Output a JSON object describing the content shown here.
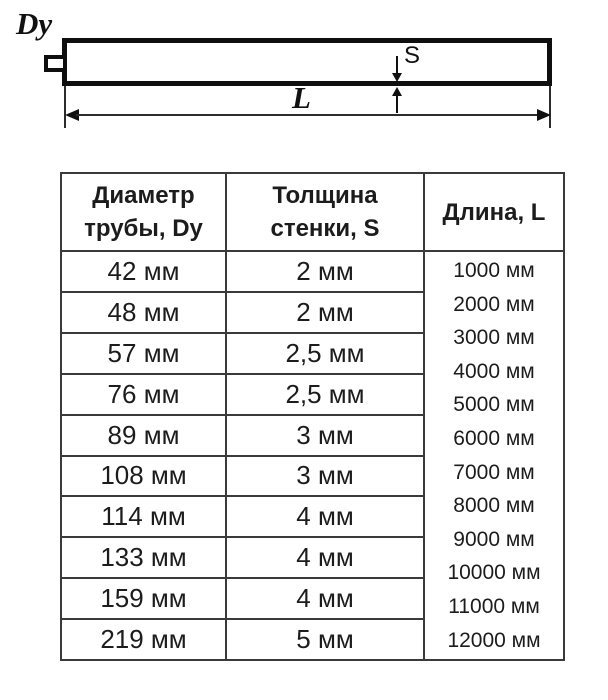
{
  "diagram": {
    "diameter_label": "Dy",
    "wall_thickness_label": "S",
    "length_label": "L"
  },
  "table": {
    "header": {
      "diameter_lines": [
        "Диаметр",
        "трубы, Dy"
      ],
      "thickness_lines": [
        "Толщина",
        "стенки, S"
      ],
      "length": "Длина, L"
    },
    "rows": [
      {
        "diameter": "42 мм",
        "thickness": "2 мм"
      },
      {
        "diameter": "48 мм",
        "thickness": "2 мм"
      },
      {
        "diameter": "57 мм",
        "thickness": "2,5 мм"
      },
      {
        "diameter": "76 мм",
        "thickness": "2,5 мм"
      },
      {
        "diameter": "89 мм",
        "thickness": "3 мм"
      },
      {
        "diameter": "108 мм",
        "thickness": "3 мм"
      },
      {
        "diameter": "114 мм",
        "thickness": "4 мм"
      },
      {
        "diameter": "133 мм",
        "thickness": "4 мм"
      },
      {
        "diameter": "159 мм",
        "thickness": "4 мм"
      },
      {
        "diameter": "219 мм",
        "thickness": "5 мм"
      }
    ],
    "lengths": [
      "1000 мм",
      "2000 мм",
      "3000 мм",
      "4000 мм",
      "5000 мм",
      "6000 мм",
      "7000 мм",
      "8000 мм",
      "9000 мм",
      "10000 мм",
      "11000 мм",
      "12000 мм"
    ]
  }
}
